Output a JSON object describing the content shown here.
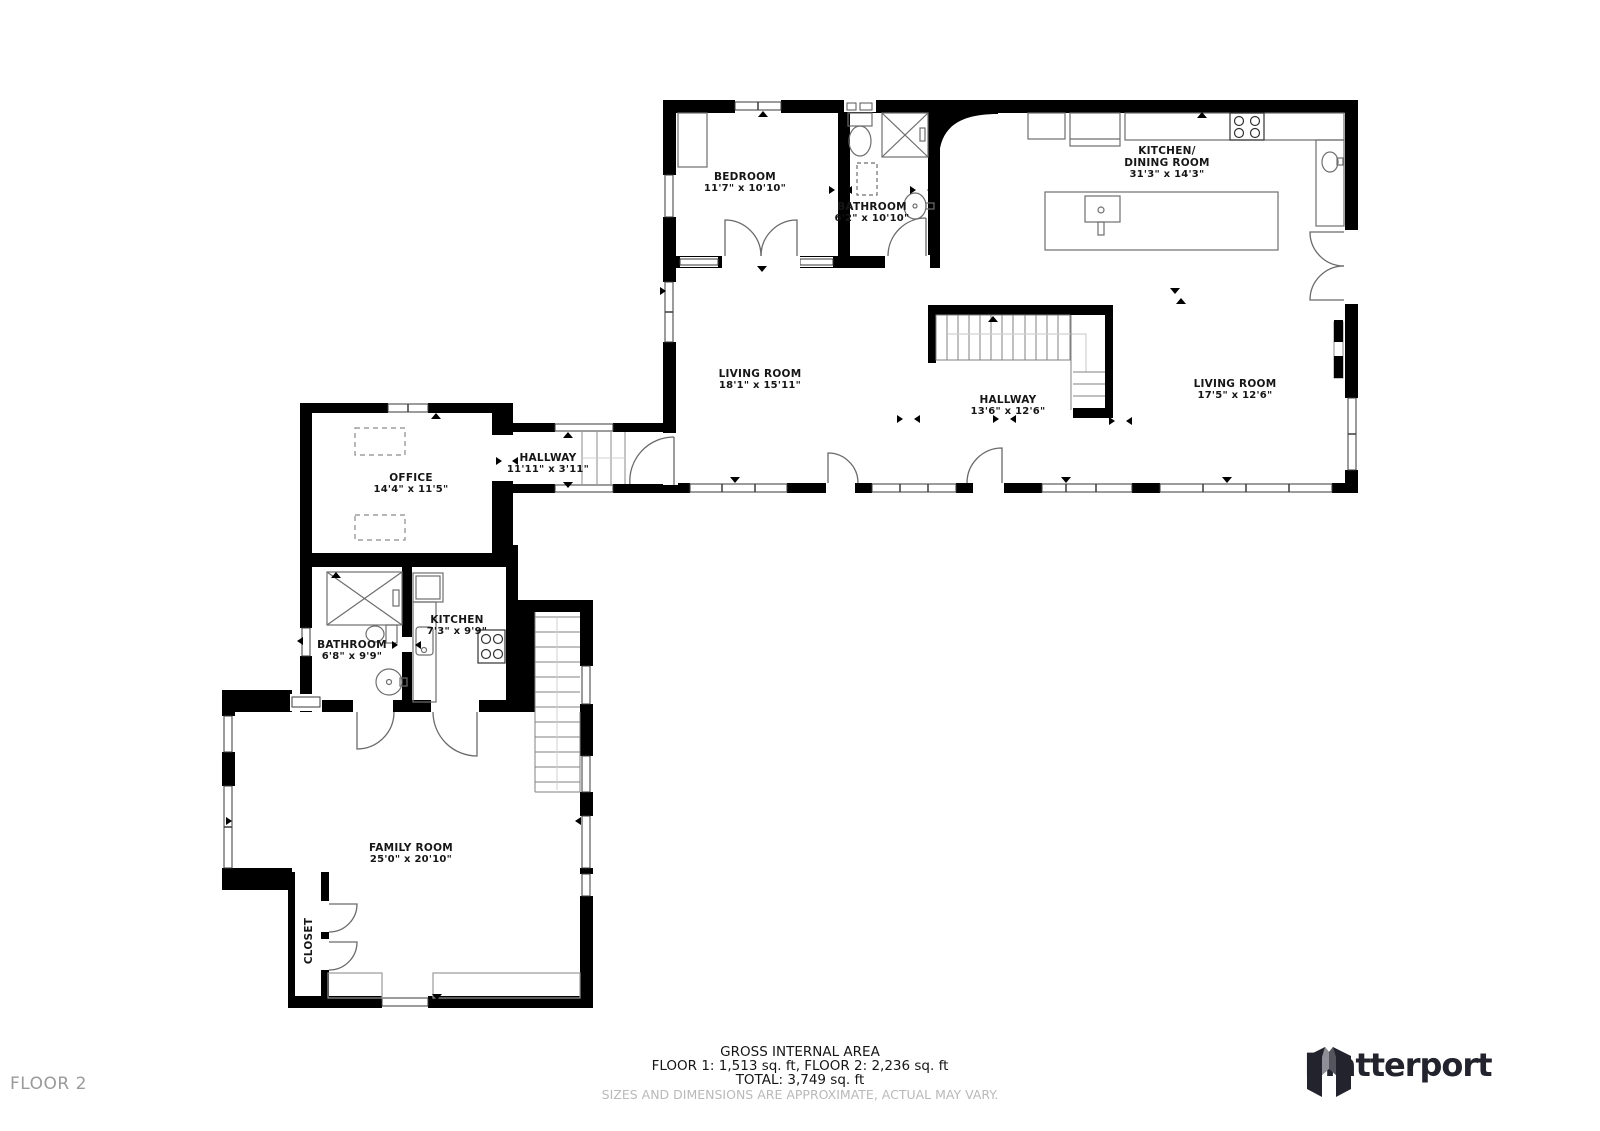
{
  "floor": {
    "label": "FLOOR 2"
  },
  "rooms": {
    "bedroom": {
      "name": "BEDROOM",
      "dims": "11'7\" x 10'10\""
    },
    "bathroom_upper": {
      "name": "BATHROOM",
      "dims": "6'2\" x 10'10\""
    },
    "kitchen_dining": {
      "name_line1": "KITCHEN/",
      "name_line2": "DINING ROOM",
      "dims": "31'3\" x 14'3\""
    },
    "living_room_left": {
      "name": "LIVING ROOM",
      "dims": "18'1\" x 15'11\""
    },
    "hallway_main": {
      "name": "HALLWAY",
      "dims": "13'6\" x 12'6\""
    },
    "living_room_right": {
      "name": "LIVING ROOM",
      "dims": "17'5\" x 12'6\""
    },
    "hallway_connector": {
      "name": "HALLWAY",
      "dims": "11'11\" x 3'11\""
    },
    "office": {
      "name": "OFFICE",
      "dims": "14'4\" x 11'5\""
    },
    "kitchen_small": {
      "name": "KITCHEN",
      "dims": "7'3\" x 9'9\""
    },
    "bathroom_lower": {
      "name": "BATHROOM",
      "dims": "6'8\" x 9'9\""
    },
    "family_room": {
      "name": "FAMILY ROOM",
      "dims": "25'0\" x 20'10\""
    },
    "closet": {
      "name": "CLOSET"
    }
  },
  "summary": {
    "title": "GROSS INTERNAL AREA",
    "floors_line": "FLOOR 1: 1,513 sq. ft, FLOOR 2: 2,236 sq. ft",
    "total_line": "TOTAL: 3,749 sq. ft",
    "disclaimer": "SIZES AND DIMENSIONS ARE APPROXIMATE, ACTUAL MAY VARY."
  },
  "brand": {
    "name": "Matterport"
  },
  "colors": {
    "wall": "#000000",
    "fixture-line": "#6e6e6e",
    "text": "#161616",
    "muted": "#9a9a9a",
    "disclaimer": "#b9b9b9",
    "logo": "#23232d"
  }
}
